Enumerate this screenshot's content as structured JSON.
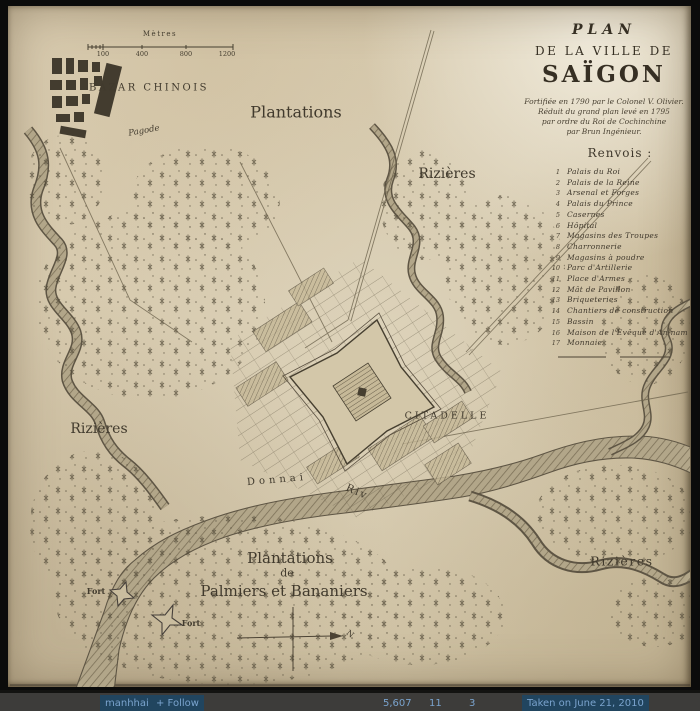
{
  "title_block": {
    "line1": "PLAN",
    "line2": "DE LA VILLE DE",
    "line3": "SAÏGON",
    "subtitle": [
      "Fortifiée en 1790 par le Colonel V. Olivier.",
      "Réduit du grand plan levé en 1795",
      "par ordre du Roi de Cochinchine",
      "par Brun Ingénieur."
    ]
  },
  "legend": {
    "title": "Renvois :",
    "items": [
      {
        "num": "1",
        "label": "Palais du Roi"
      },
      {
        "num": "2",
        "label": "Palais de la Reine"
      },
      {
        "num": "3",
        "label": "Arsenal et Forges"
      },
      {
        "num": "4",
        "label": "Palais du Prince"
      },
      {
        "num": "5",
        "label": "Casernes"
      },
      {
        "num": "6",
        "label": "Hôpital"
      },
      {
        "num": "7",
        "label": "Magasins des Troupes"
      },
      {
        "num": "8",
        "label": "Charronnerie"
      },
      {
        "num": "9",
        "label": "Magasins à poudre"
      },
      {
        "num": "10",
        "label": "Parc d'Artillerie"
      },
      {
        "num": "11",
        "label": "Place d'Armes"
      },
      {
        "num": "12",
        "label": "Mât de Pavillon"
      },
      {
        "num": "13",
        "label": "Briqueteries"
      },
      {
        "num": "14",
        "label": "Chantiers de construction"
      },
      {
        "num": "15",
        "label": "Bassin"
      },
      {
        "num": "16",
        "label": "Maison de l'Evêque d'An-nam"
      },
      {
        "num": "17",
        "label": "Monnaie"
      }
    ]
  },
  "scale_bar": {
    "title": "Mètres",
    "ticks": [
      "100",
      "400",
      "800",
      "1200"
    ]
  },
  "map_labels": [
    {
      "id": "bazar-chinois",
      "text": "BAZAR CHINOIS",
      "x": 149,
      "y": 88,
      "size": 10,
      "ls": 2.5
    },
    {
      "id": "pagode",
      "text": "Pagode",
      "x": 144,
      "y": 131,
      "size": 8.5,
      "it": 1,
      "rot": -10
    },
    {
      "id": "plantations-north",
      "text": "Plantations",
      "x": 296,
      "y": 112,
      "size": 16
    },
    {
      "id": "rizieres-northeast",
      "text": "Rizières",
      "x": 447,
      "y": 174,
      "size": 14
    },
    {
      "id": "rizieres-west",
      "text": "Rizières",
      "x": 99,
      "y": 429,
      "size": 14
    },
    {
      "id": "rizieres-southeast",
      "text": "Rizières",
      "x": 622,
      "y": 561,
      "size": 12.5,
      "ls": 1.5
    },
    {
      "id": "citadelle",
      "text": "CITADELLE",
      "x": 447,
      "y": 416,
      "size": 9.5,
      "ls": 3
    },
    {
      "id": "donnai-river",
      "text": "Donnai",
      "x": 277,
      "y": 480,
      "size": 10,
      "ls": 4,
      "rot": -5
    },
    {
      "id": "riv-abbrev",
      "text": "Riv",
      "x": 357,
      "y": 492,
      "size": 10.5,
      "ls": 2,
      "rot": 24
    },
    {
      "id": "plantations-south-line1",
      "text": "Plantations",
      "x": 290,
      "y": 558,
      "size": 15
    },
    {
      "id": "plantations-south-line2",
      "text": "de",
      "x": 287,
      "y": 573,
      "size": 11
    },
    {
      "id": "plantations-south-line3",
      "text": "Palmiers et Bananiers",
      "x": 284,
      "y": 591,
      "size": 15
    },
    {
      "id": "fort-west",
      "text": "Fort",
      "x": 96,
      "y": 591,
      "size": 8,
      "w": 700
    },
    {
      "id": "fort-south",
      "text": "Fort",
      "x": 191,
      "y": 623,
      "size": 8,
      "w": 700
    },
    {
      "id": "compass-north",
      "text": "N",
      "x": 350,
      "y": 634,
      "size": 8,
      "rot": 40
    }
  ],
  "footer": {
    "user": "manhhai",
    "follow": "+ Follow",
    "views": "5,607",
    "faves": "11",
    "comments": "3",
    "taken": "Taken on June 21, 2010"
  },
  "colors": {
    "paper": "#d5c9ae",
    "ink": "#453e32",
    "river_edge": "#5e5544",
    "footer_bar": "#3d3c3a",
    "footer_link": "#7aa3cd"
  }
}
